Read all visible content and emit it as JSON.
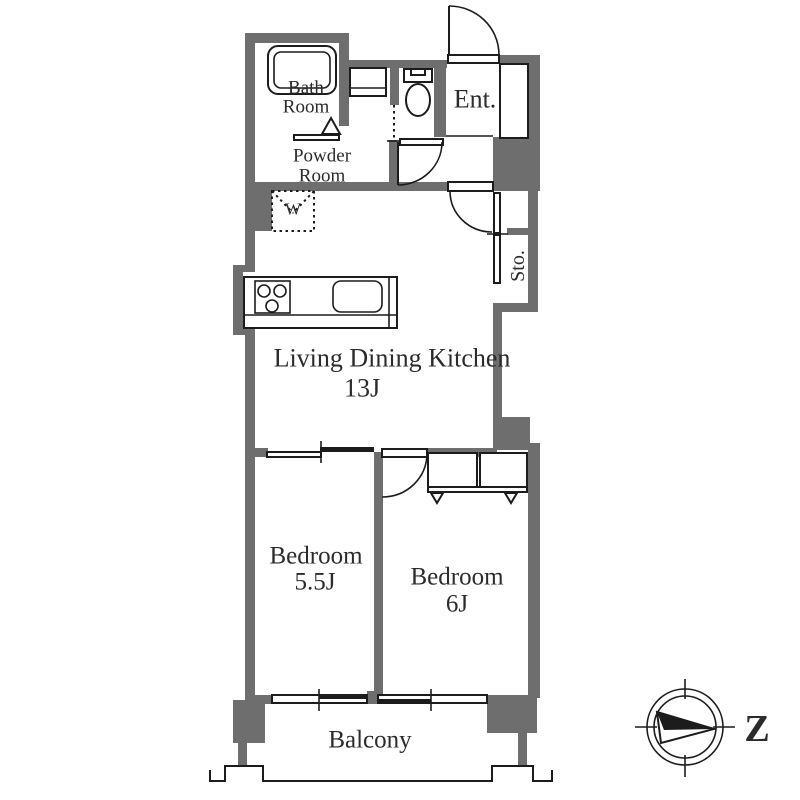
{
  "colors": {
    "wall": "#6e6e6e",
    "line": "#1c1c1c",
    "text": "#2b2b2b",
    "background": "#ffffff"
  },
  "rooms": {
    "bath": {
      "line1": "Bath",
      "line2": "Room"
    },
    "powder": {
      "line1": "Powder",
      "line2": "Room"
    },
    "entrance": {
      "label": "Ent."
    },
    "washer": {
      "label": "W"
    },
    "storage": {
      "label": "Sto."
    },
    "ldk": {
      "line1": "Living Dining Kitchen",
      "line2": "13J"
    },
    "bedroom1": {
      "line1": "Bedroom",
      "line2": "5.5J"
    },
    "bedroom2": {
      "line1": "Bedroom",
      "line2": "6J"
    },
    "balcony": {
      "label": "Balcony"
    }
  },
  "compass": {
    "north_label": "Z"
  }
}
